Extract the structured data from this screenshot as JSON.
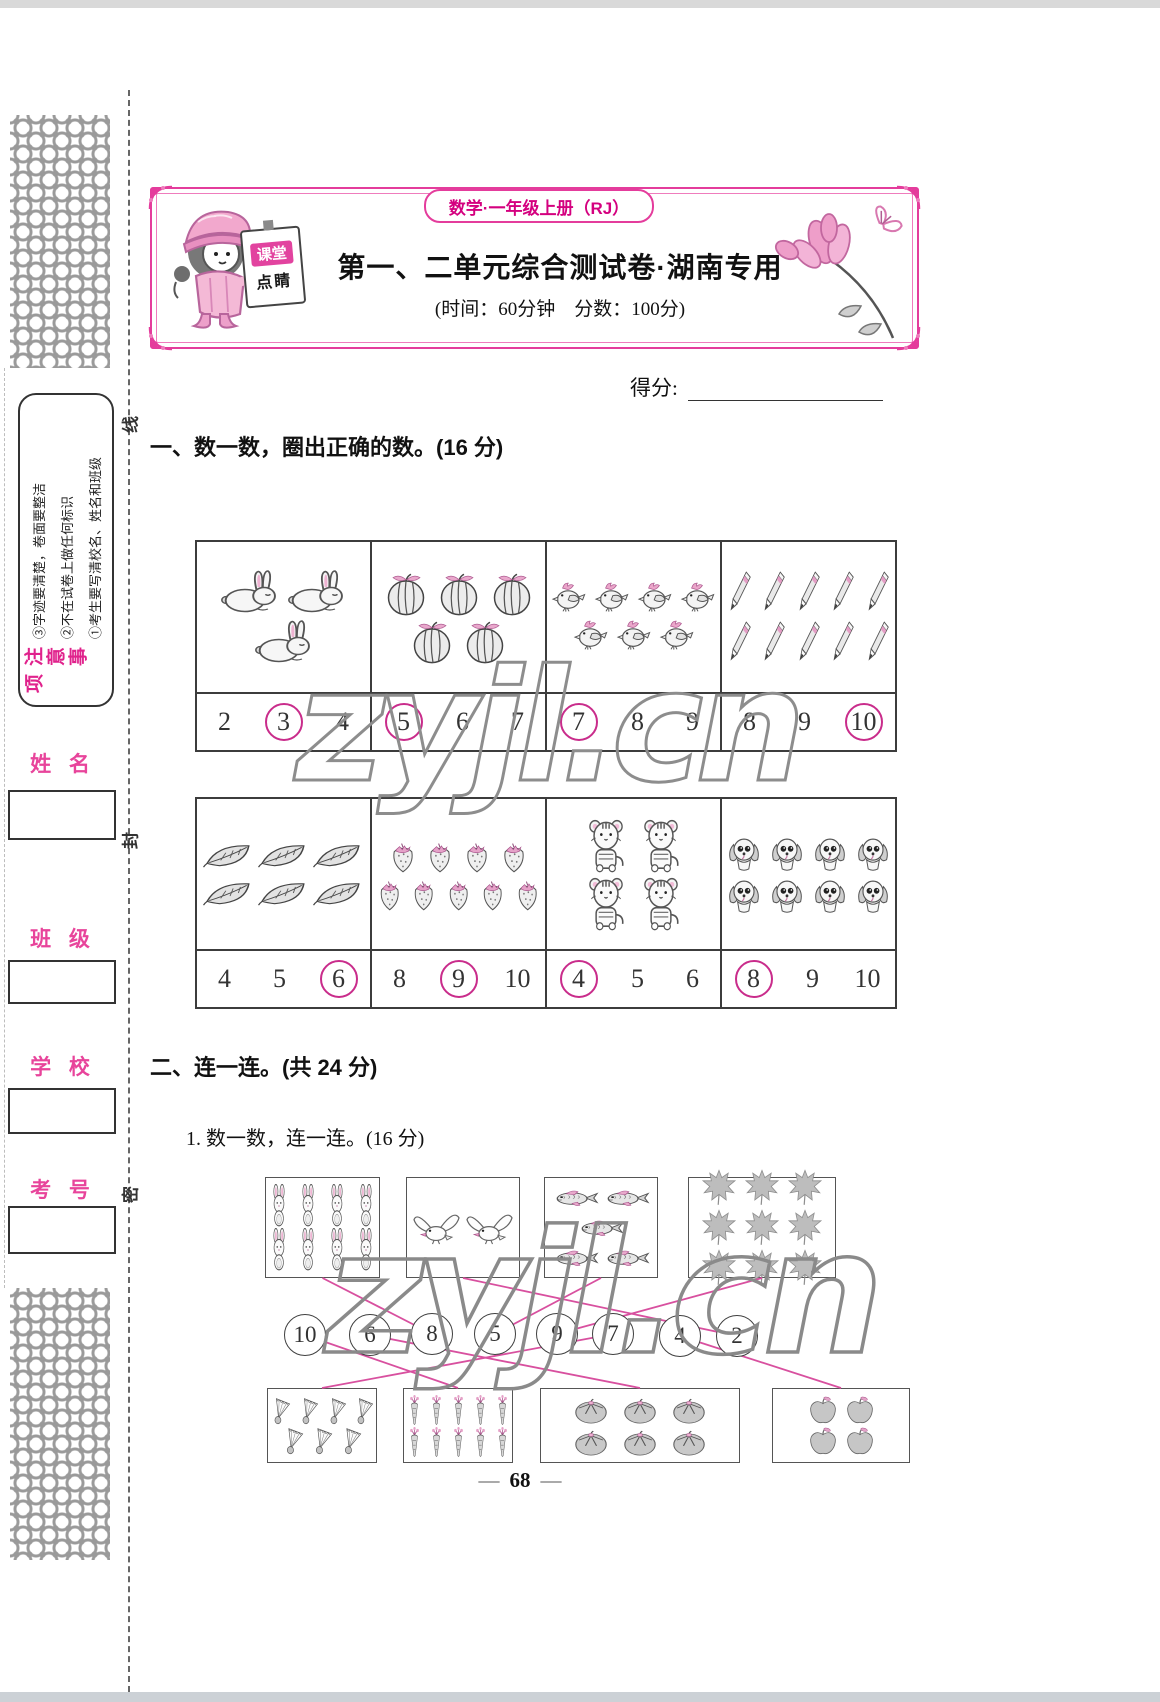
{
  "watermark": {
    "text": "zyjl.cn"
  },
  "header": {
    "badge": "数学·一年级上册（RJ）",
    "title": "第一、二单元综合测试卷·湖南专用",
    "meta": "(时间：60分钟　分数：100分)",
    "sign_top": "课堂",
    "sign_bottom": "点睛"
  },
  "sidebar": {
    "notice_title": "注意事项",
    "notice_items": [
      "①考生要写清校名、姓名和班级",
      "②不在试卷上做任何标识",
      "③字迹要清楚，卷面要整洁"
    ],
    "seal_chars": [
      "线",
      "封",
      "密"
    ],
    "fields": [
      {
        "label": "姓 名"
      },
      {
        "label": "班 级"
      },
      {
        "label": "学 校"
      },
      {
        "label": "考 号"
      }
    ]
  },
  "score": {
    "label": "得分:"
  },
  "q1": {
    "heading": "一、数一数，圈出正确的数。(16 分)",
    "rows": [
      [
        {
          "item": "rabbit",
          "count": 3,
          "arrange": [
            2,
            1
          ],
          "options": [
            {
              "v": "2",
              "circled": false
            },
            {
              "v": "3",
              "circled": true
            },
            {
              "v": "4",
              "circled": false
            }
          ]
        },
        {
          "item": "watermelon",
          "count": 5,
          "arrange": [
            3,
            2
          ],
          "options": [
            {
              "v": "5",
              "circled": true
            },
            {
              "v": "6",
              "circled": false
            },
            {
              "v": "7",
              "circled": false
            }
          ]
        },
        {
          "item": "bird",
          "count": 7,
          "arrange": [
            4,
            3
          ],
          "options": [
            {
              "v": "7",
              "circled": true
            },
            {
              "v": "8",
              "circled": false
            },
            {
              "v": "9",
              "circled": false
            }
          ]
        },
        {
          "item": "pencil",
          "count": 10,
          "arrange": [
            5,
            5
          ],
          "options": [
            {
              "v": "8",
              "circled": false
            },
            {
              "v": "9",
              "circled": false
            },
            {
              "v": "10",
              "circled": true
            }
          ]
        }
      ],
      [
        {
          "item": "leaf",
          "count": 6,
          "arrange": [
            3,
            3
          ],
          "options": [
            {
              "v": "4",
              "circled": false
            },
            {
              "v": "5",
              "circled": false
            },
            {
              "v": "6",
              "circled": true
            }
          ]
        },
        {
          "item": "strawberry",
          "count": 9,
          "arrange": [
            4,
            5
          ],
          "options": [
            {
              "v": "8",
              "circled": false
            },
            {
              "v": "9",
              "circled": true
            },
            {
              "v": "10",
              "circled": false
            }
          ]
        },
        {
          "item": "tiger",
          "count": 4,
          "arrange": [
            2,
            2
          ],
          "options": [
            {
              "v": "4",
              "circled": true
            },
            {
              "v": "5",
              "circled": false
            },
            {
              "v": "6",
              "circled": false
            }
          ]
        },
        {
          "item": "dog",
          "count": 8,
          "arrange": [
            4,
            4
          ],
          "options": [
            {
              "v": "8",
              "circled": true
            },
            {
              "v": "9",
              "circled": false
            },
            {
              "v": "10",
              "circled": false
            }
          ]
        }
      ]
    ]
  },
  "q2": {
    "heading": "二、连一连。(共 24 分)",
    "sub_heading": "1. 数一数，连一连。(16 分)",
    "top_boxes": [
      {
        "item": "bunny",
        "count": 8,
        "arrange": [
          4,
          4
        ]
      },
      {
        "item": "bird2",
        "count": 2,
        "arrange": [
          2
        ]
      },
      {
        "item": "fish",
        "count": 5,
        "arrange": [
          2,
          1,
          2
        ]
      },
      {
        "item": "maple",
        "count": 9,
        "arrange": [
          3,
          3,
          3
        ]
      }
    ],
    "circles": [
      "10",
      "6",
      "8",
      "5",
      "9",
      "7",
      "4",
      "2"
    ],
    "bottom_boxes": [
      {
        "item": "shuttlecock",
        "count": 7,
        "arrange": [
          4,
          3
        ]
      },
      {
        "item": "carrot",
        "count": 10,
        "arrange": [
          5,
          5
        ]
      },
      {
        "item": "persimmon",
        "count": 6,
        "arrange": [
          3,
          3
        ]
      },
      {
        "item": "apple",
        "count": 4,
        "arrange": [
          2,
          2
        ]
      }
    ],
    "connections": [
      {
        "from": "top-0",
        "to": "circle-2"
      },
      {
        "from": "top-1",
        "to": "circle-7"
      },
      {
        "from": "top-2",
        "to": "circle-3"
      },
      {
        "from": "top-3",
        "to": "circle-4"
      },
      {
        "from": "circle-0",
        "to": "bottom-1"
      },
      {
        "from": "circle-1",
        "to": "bottom-2"
      },
      {
        "from": "circle-5",
        "to": "bottom-0"
      },
      {
        "from": "circle-6",
        "to": "bottom-3"
      }
    ]
  },
  "footer": {
    "page_number": "68",
    "dash": "—"
  },
  "colors": {
    "frame_pink": "#e43c9c",
    "magenta_text": "#d4007f",
    "label_pink": "#e8449b",
    "answer_circle": "#c92c8b",
    "connect_line": "#d8509f",
    "watermark_gray": "#8d8d8d"
  }
}
